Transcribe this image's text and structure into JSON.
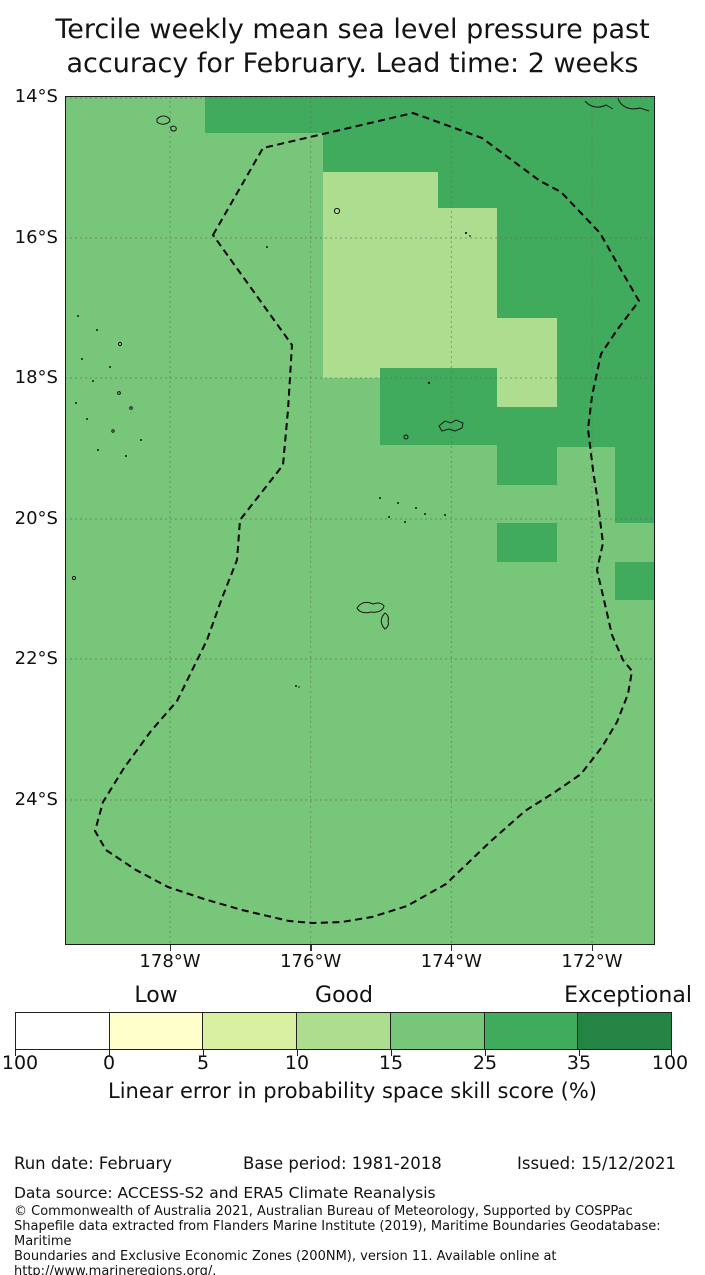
{
  "title": {
    "line1": "Tercile weekly mean sea level pressure past",
    "line2": "accuracy for February. Lead time: 2 weeks"
  },
  "map": {
    "lat_ticks": [
      "14°S",
      "16°S",
      "18°S",
      "20°S",
      "22°S",
      "24°S"
    ],
    "lon_ticks": [
      "178°W",
      "176°W",
      "174°W",
      "172°W"
    ]
  },
  "colorbar": {
    "band_labels": [
      "Low",
      "Good",
      "Exceptional"
    ],
    "tick_labels": [
      "100",
      "0",
      "5",
      "10",
      "15",
      "25",
      "35",
      "100"
    ],
    "caption": "Linear error in probability space skill score (%)",
    "segment_colors": [
      "#ffffff",
      "#ffffcc",
      "#d9f0a3",
      "#addd8e",
      "#78c679",
      "#41ab5d",
      "#238443"
    ]
  },
  "meta": {
    "run_date": "Run date: February",
    "base_period": "Base period: 1981-2018",
    "issued": "Issued: 15/12/2021",
    "data_source": "Data source: ACCESS-S2 and ERA5 Climate Reanalysis",
    "copyright": "© Commonwealth of Australia 2021, Australian Bureau of Meteorology, Supported by COSPPac\nShapefile data extracted from Flanders Marine Institute (2019), Maritime Boundaries Geodatabase: Maritime\nBoundaries and Exclusive Economic Zones (200NM), version 11. Available online at\nhttp://www.marineregions.org/."
  },
  "chart_data": {
    "type": "heatmap",
    "title": "Tercile weekly mean sea level pressure past accuracy for February. Lead time: 2 weeks",
    "variable": "Linear error in probability space skill score (%)",
    "month": "February",
    "lead_time": "2 weeks",
    "x": {
      "label": "Longitude",
      "ticks": [
        "178°W",
        "176°W",
        "174°W",
        "172°W"
      ],
      "range_deg_west": [
        179.5,
        171.1
      ]
    },
    "y": {
      "label": "Latitude",
      "ticks": [
        "14°S",
        "16°S",
        "18°S",
        "20°S",
        "22°S",
        "24°S"
      ],
      "range_deg_south": [
        14.0,
        26.1
      ]
    },
    "colorbar": {
      "bin_edges": [
        -100,
        0,
        5,
        10,
        15,
        25,
        35,
        100
      ],
      "colors": [
        "#ffffff",
        "#ffffcc",
        "#d9f0a3",
        "#addd8e",
        "#78c679",
        "#41ab5d",
        "#238443"
      ],
      "band_label_positions": {
        "Low": "over 0-5 bin",
        "Good": "over 10-15 bin",
        "Exceptional": "over 35-100 bin"
      }
    },
    "colors": {
      "background": "#78c679",
      "light": "#addd8e",
      "dark": "#41ab5d"
    },
    "map_values": {
      "background_bin_percent": "15-25",
      "dark_bin_percent": "25-35",
      "light_bin_percent": "10-15",
      "dark_staircase_steps_lonW_to_latS": [
        [
          177.5,
          14.5
        ],
        [
          175.8,
          15.1
        ],
        [
          174.2,
          15.6
        ],
        [
          173.3,
          17.1
        ],
        [
          172.5,
          19.0
        ],
        [
          171.7,
          20.1
        ]
      ],
      "light_patches_lonW_latS_bounds": [
        [
          175.8,
          174.2,
          15.1,
          18.0
        ],
        [
          174.2,
          173.3,
          15.6,
          18.0
        ],
        [
          173.3,
          172.5,
          17.1,
          18.4
        ]
      ],
      "isolated_dark_patches_lonW_latS_bounds": [
        [
          175.0,
          173.3,
          17.85,
          18.95
        ],
        [
          173.3,
          172.5,
          18.4,
          19.5
        ],
        [
          173.3,
          172.5,
          20.05,
          20.6
        ],
        [
          171.7,
          171.1,
          20.6,
          21.15
        ]
      ]
    },
    "overlays": [
      "dashed EEZ boundary polygon",
      "island coastline outlines",
      "2-degree dashed graticule"
    ],
    "legend_position": "horizontal colorbar below map",
    "grid": true
  }
}
